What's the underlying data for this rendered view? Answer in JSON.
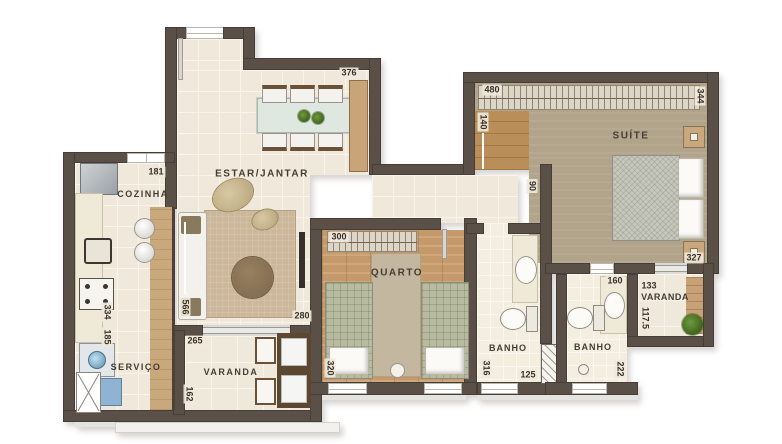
{
  "plan": {
    "rooms": {
      "estar_jantar": "ESTAR/JANTAR",
      "cozinha": "COZINHA",
      "servico": "SERVIÇO",
      "varanda_social": "VARANDA",
      "quarto": "QUARTO",
      "banho_social": "BANHO",
      "banho_suite": "BANHO",
      "suite": "SUÍTE",
      "varanda_suite": "VARANDA"
    },
    "dimensions": {
      "estar_top": "376",
      "cozinha_top": "181",
      "cozinha_len": "334",
      "servico_len": "185",
      "estar_left": "566",
      "estar_right": "280",
      "varanda_social_w": "265",
      "varanda_social_d": "162",
      "quarto_w": "300",
      "quarto_d": "320",
      "banho_social_d": "316",
      "banho_social_w": "125",
      "hall_w": "90",
      "suite_entry_w": "140",
      "suite_w": "480",
      "suite_d": "344",
      "suite_bed_wall": "327",
      "banho_suite_w": "160",
      "banho_suite_d": "222",
      "varanda_suite_w": "133",
      "varanda_suite_d": "117.5"
    },
    "colors": {
      "wall": "#5b5047",
      "tile_floor": "#f0e8da",
      "wood_floor": "#c49a6c",
      "suite_floor": "#b2a48b",
      "plant_green": "#4e7a2e"
    }
  }
}
